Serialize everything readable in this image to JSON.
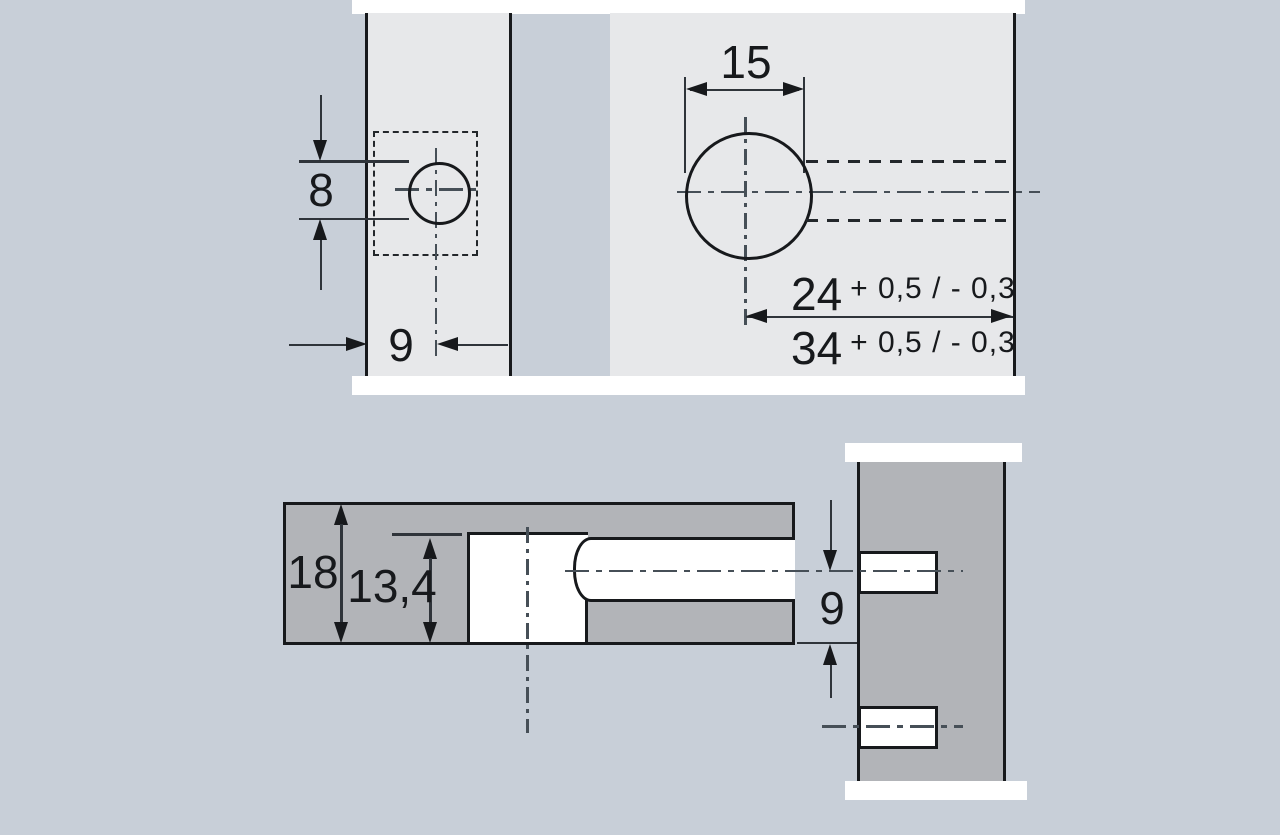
{
  "colors": {
    "background": "#c8cfd8",
    "board_face_light": "#e7e8ea",
    "board_section_gray": "#b2b4b8",
    "edge_strip_white": "#ffffff",
    "object_line": "#17191c",
    "dimension_line": "#2f343a",
    "center_line": "#464f57"
  },
  "top_view": {
    "small_hole_diameter": "8",
    "small_hole_edge_offset": "9",
    "large_hole_diameter": "15",
    "distance_24": "24",
    "distance_24_tolerance": "+ 0,5 / - 0,3",
    "distance_34": "34",
    "distance_34_tolerance": "+ 0,5 / - 0,3"
  },
  "section_view": {
    "board_thickness": "18",
    "drilling_depth": "13,4",
    "hole_center_to_edge": "9"
  }
}
